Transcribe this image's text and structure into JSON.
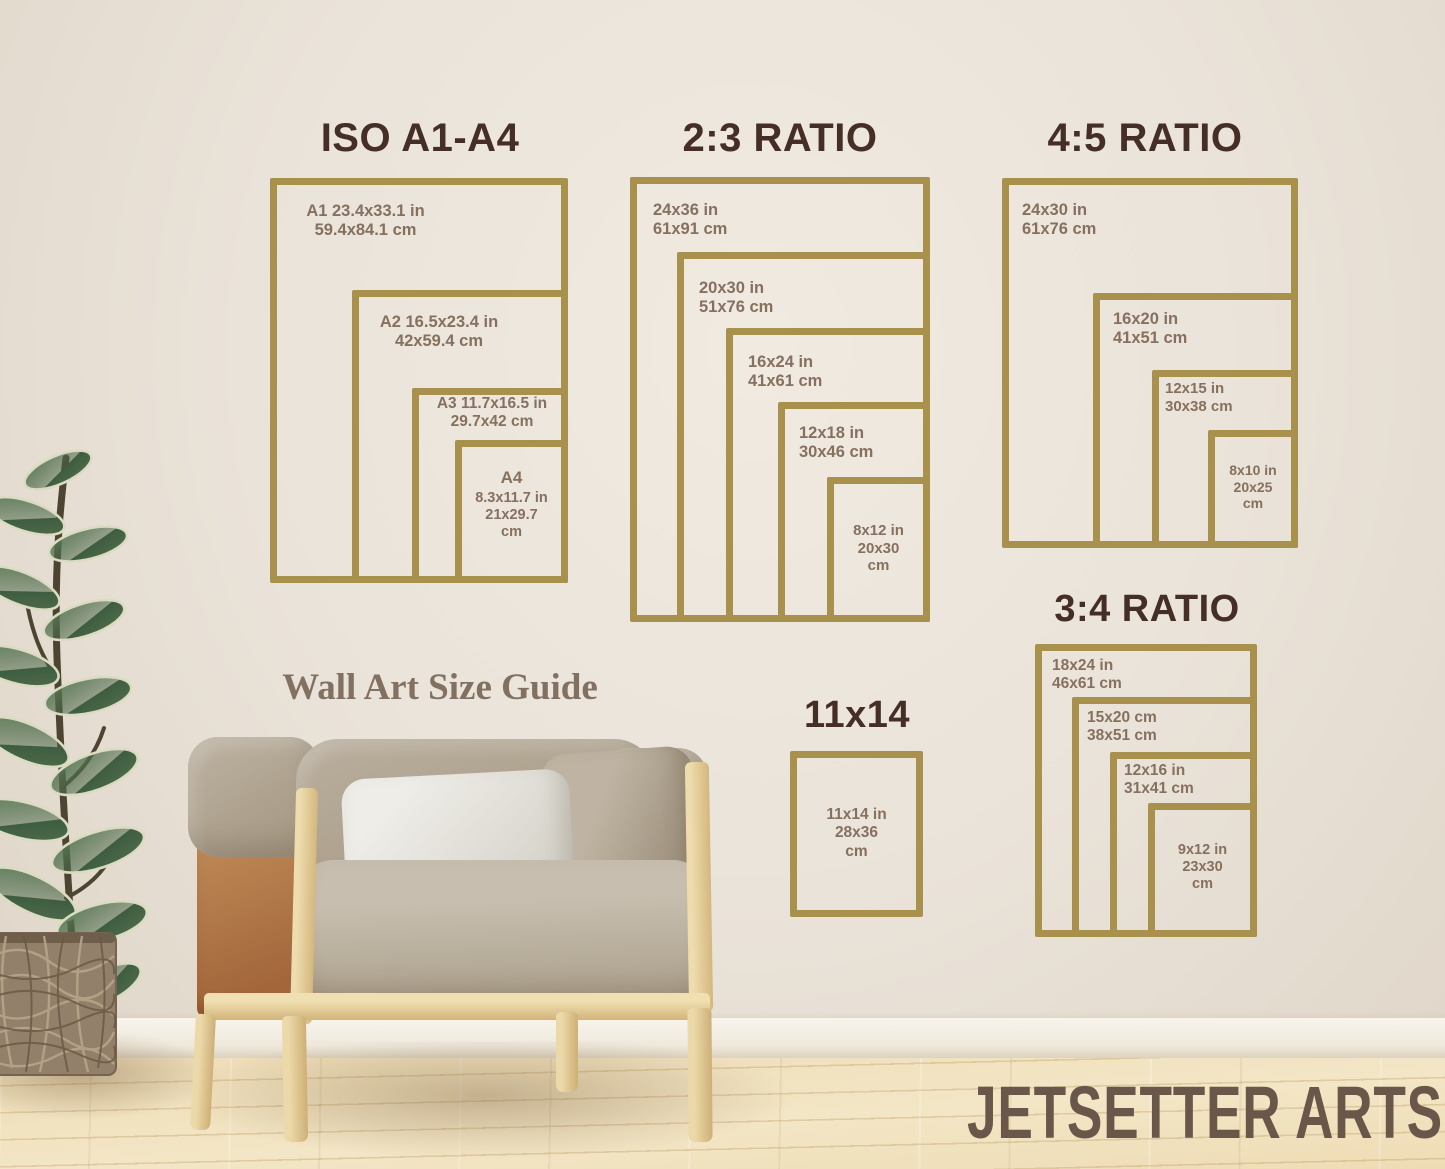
{
  "texts": {
    "guide_title": "Wall Art Size Guide",
    "brand": "JETSETTER ARTS"
  },
  "colors": {
    "frame_gold": "#a8914d",
    "heading_brown": "#442e25",
    "label_brown": "#86705e",
    "wall_beige": "#eae3d9",
    "floor_wood": "#f0e1bd",
    "leather_tan": "#ab6f40",
    "cushion_taupe": "#b2a796",
    "leaf_green": "#4c6b4a"
  },
  "groups": {
    "iso": {
      "title": "ISO A1-A4",
      "frames": [
        {
          "name": "A1",
          "lines": [
            "A1 23.4x33.1 in",
            "59.4x84.1 cm"
          ]
        },
        {
          "name": "A2",
          "lines": [
            "A2 16.5x23.4 in",
            "42x59.4 cm"
          ]
        },
        {
          "name": "A3",
          "lines": [
            "A3 11.7x16.5 in",
            "29.7x42 cm"
          ]
        },
        {
          "name": "A4",
          "lines": [
            "A4",
            "8.3x11.7 in",
            "21x29.7",
            "cm"
          ]
        }
      ]
    },
    "ratio_2_3": {
      "title": "2:3 RATIO",
      "frames": [
        {
          "name": "24x36",
          "lines": [
            "24x36 in",
            "61x91 cm"
          ]
        },
        {
          "name": "20x30",
          "lines": [
            "20x30 in",
            "51x76 cm"
          ]
        },
        {
          "name": "16x24",
          "lines": [
            "16x24 in",
            "41x61 cm"
          ]
        },
        {
          "name": "12x18",
          "lines": [
            "12x18 in",
            "30x46 cm"
          ]
        },
        {
          "name": "8x12",
          "lines": [
            "8x12 in",
            "20x30",
            "cm"
          ]
        }
      ]
    },
    "ratio_4_5": {
      "title": "4:5 RATIO",
      "frames": [
        {
          "name": "24x30",
          "lines": [
            "24x30 in",
            "61x76 cm"
          ]
        },
        {
          "name": "16x20",
          "lines": [
            "16x20 in",
            "41x51 cm"
          ]
        },
        {
          "name": "12x15",
          "lines": [
            "12x15 in",
            "30x38 cm"
          ]
        },
        {
          "name": "8x10",
          "lines": [
            "8x10 in",
            "20x25",
            "cm"
          ]
        }
      ]
    },
    "ratio_3_4": {
      "title": "3:4 RATIO",
      "frames": [
        {
          "name": "18x24",
          "lines": [
            "18x24 in",
            "46x61 cm"
          ]
        },
        {
          "name": "15x20",
          "lines": [
            "15x20 cm",
            "38x51 cm"
          ]
        },
        {
          "name": "12x16",
          "lines": [
            "12x16 in",
            "31x41 cm"
          ]
        },
        {
          "name": "9x12",
          "lines": [
            "9x12 in",
            "23x30",
            "cm"
          ]
        }
      ]
    },
    "size_11x14": {
      "title": "11x14",
      "frames": [
        {
          "name": "11x14",
          "lines": [
            "11x14 in",
            "28x36",
            "cm"
          ]
        }
      ]
    }
  }
}
